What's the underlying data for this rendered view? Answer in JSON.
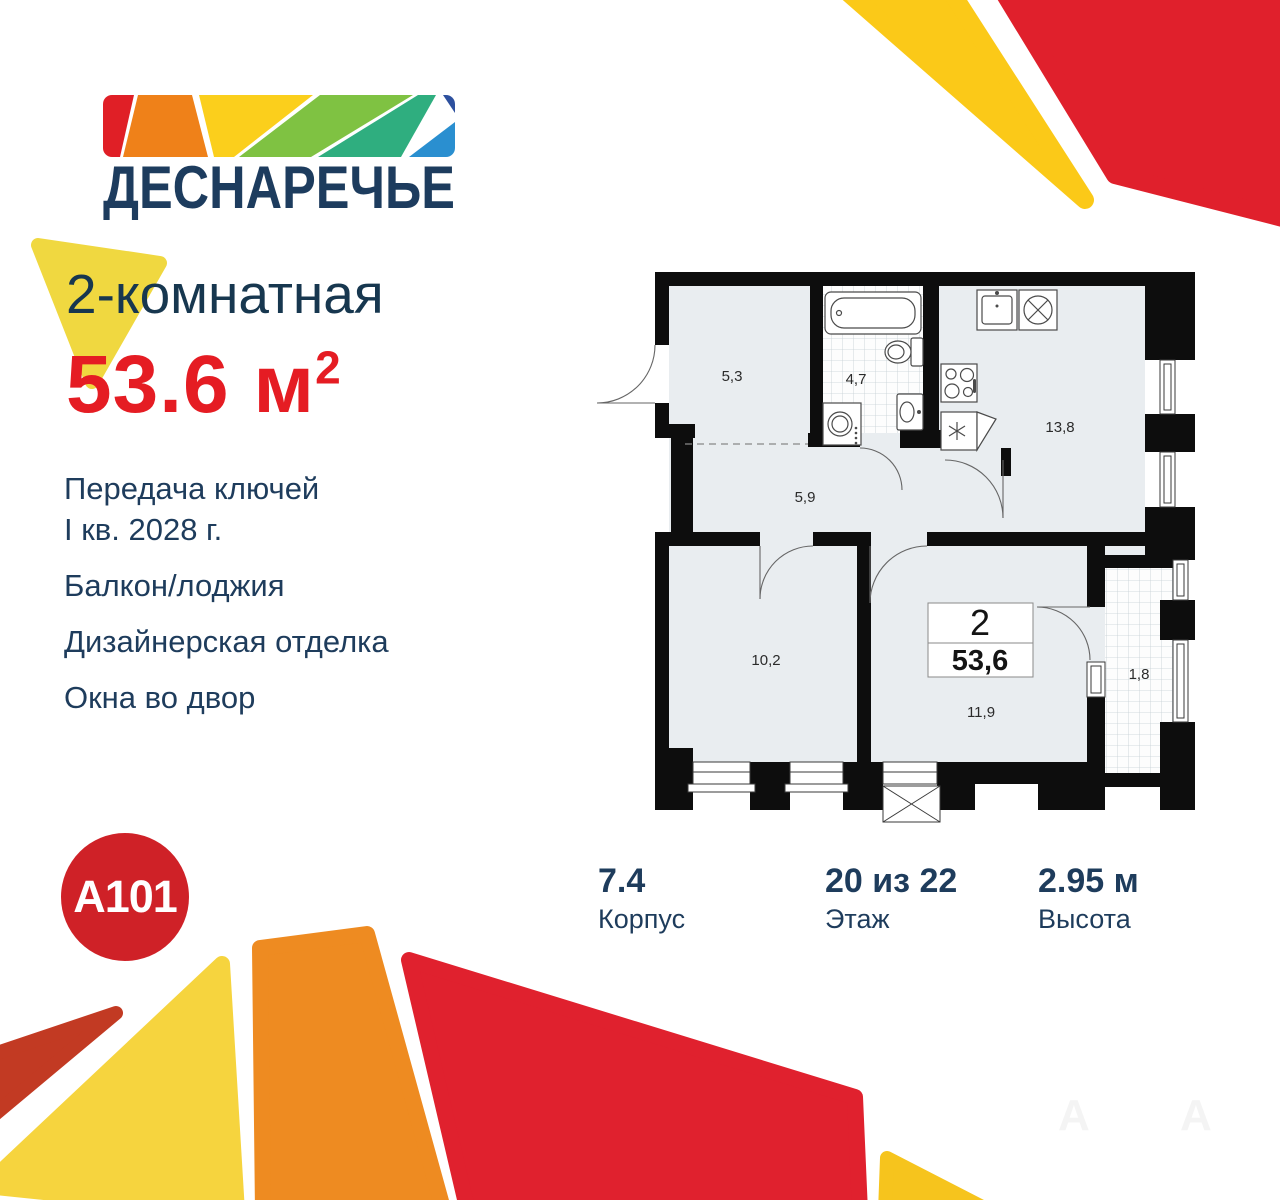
{
  "brand": {
    "name": "ДЕСНАРЕЧЬЕ",
    "developer": "A101"
  },
  "listing": {
    "type_title": "2-комнатная",
    "area_value": "53.6",
    "area_unit": "м",
    "area_exponent": "2"
  },
  "features": {
    "delivery_line1": "Передача ключей",
    "delivery_line2": "I кв. 2028 г.",
    "balcony": "Балкон/лоджия",
    "finish": "Дизайнерская отделка",
    "windows": "Окна во двор"
  },
  "plan": {
    "rooms": {
      "entry_hall": "5,3",
      "bathroom": "4,7",
      "corridor": "5,9",
      "kitchen": "13,8",
      "bedroom": "10,2",
      "living_room": "11,9",
      "balcony": "1,8"
    },
    "info_box": {
      "rooms_count": "2",
      "total_area": "53,6"
    }
  },
  "stats": {
    "building_value": "7.4",
    "building_label": "Корпус",
    "floor_value": "20 из 22",
    "floor_label": "Этаж",
    "height_value": "2.95 м",
    "height_label": "Высота"
  },
  "colors": {
    "navy": "#1e3c5c",
    "accent_red": "#e51c23",
    "a101_red": "#cf2127",
    "mosaic_red": "#e01f26",
    "mosaic_orange": "#ef8119",
    "mosaic_yellow": "#fbcf1c",
    "mosaic_green": "#7fc242",
    "mosaic_teal": "#2fae7f",
    "mosaic_darkblue": "#2d509e",
    "mosaic_lightblue": "#2a8fd0",
    "deco_yellow": "#f6d43e",
    "deco_orange": "#ee8b21",
    "deco_red": "#e0212e",
    "deco_brick": "#c23a23",
    "plan_wall": "#0d0d0d",
    "plan_floor": "#e9edf0"
  }
}
